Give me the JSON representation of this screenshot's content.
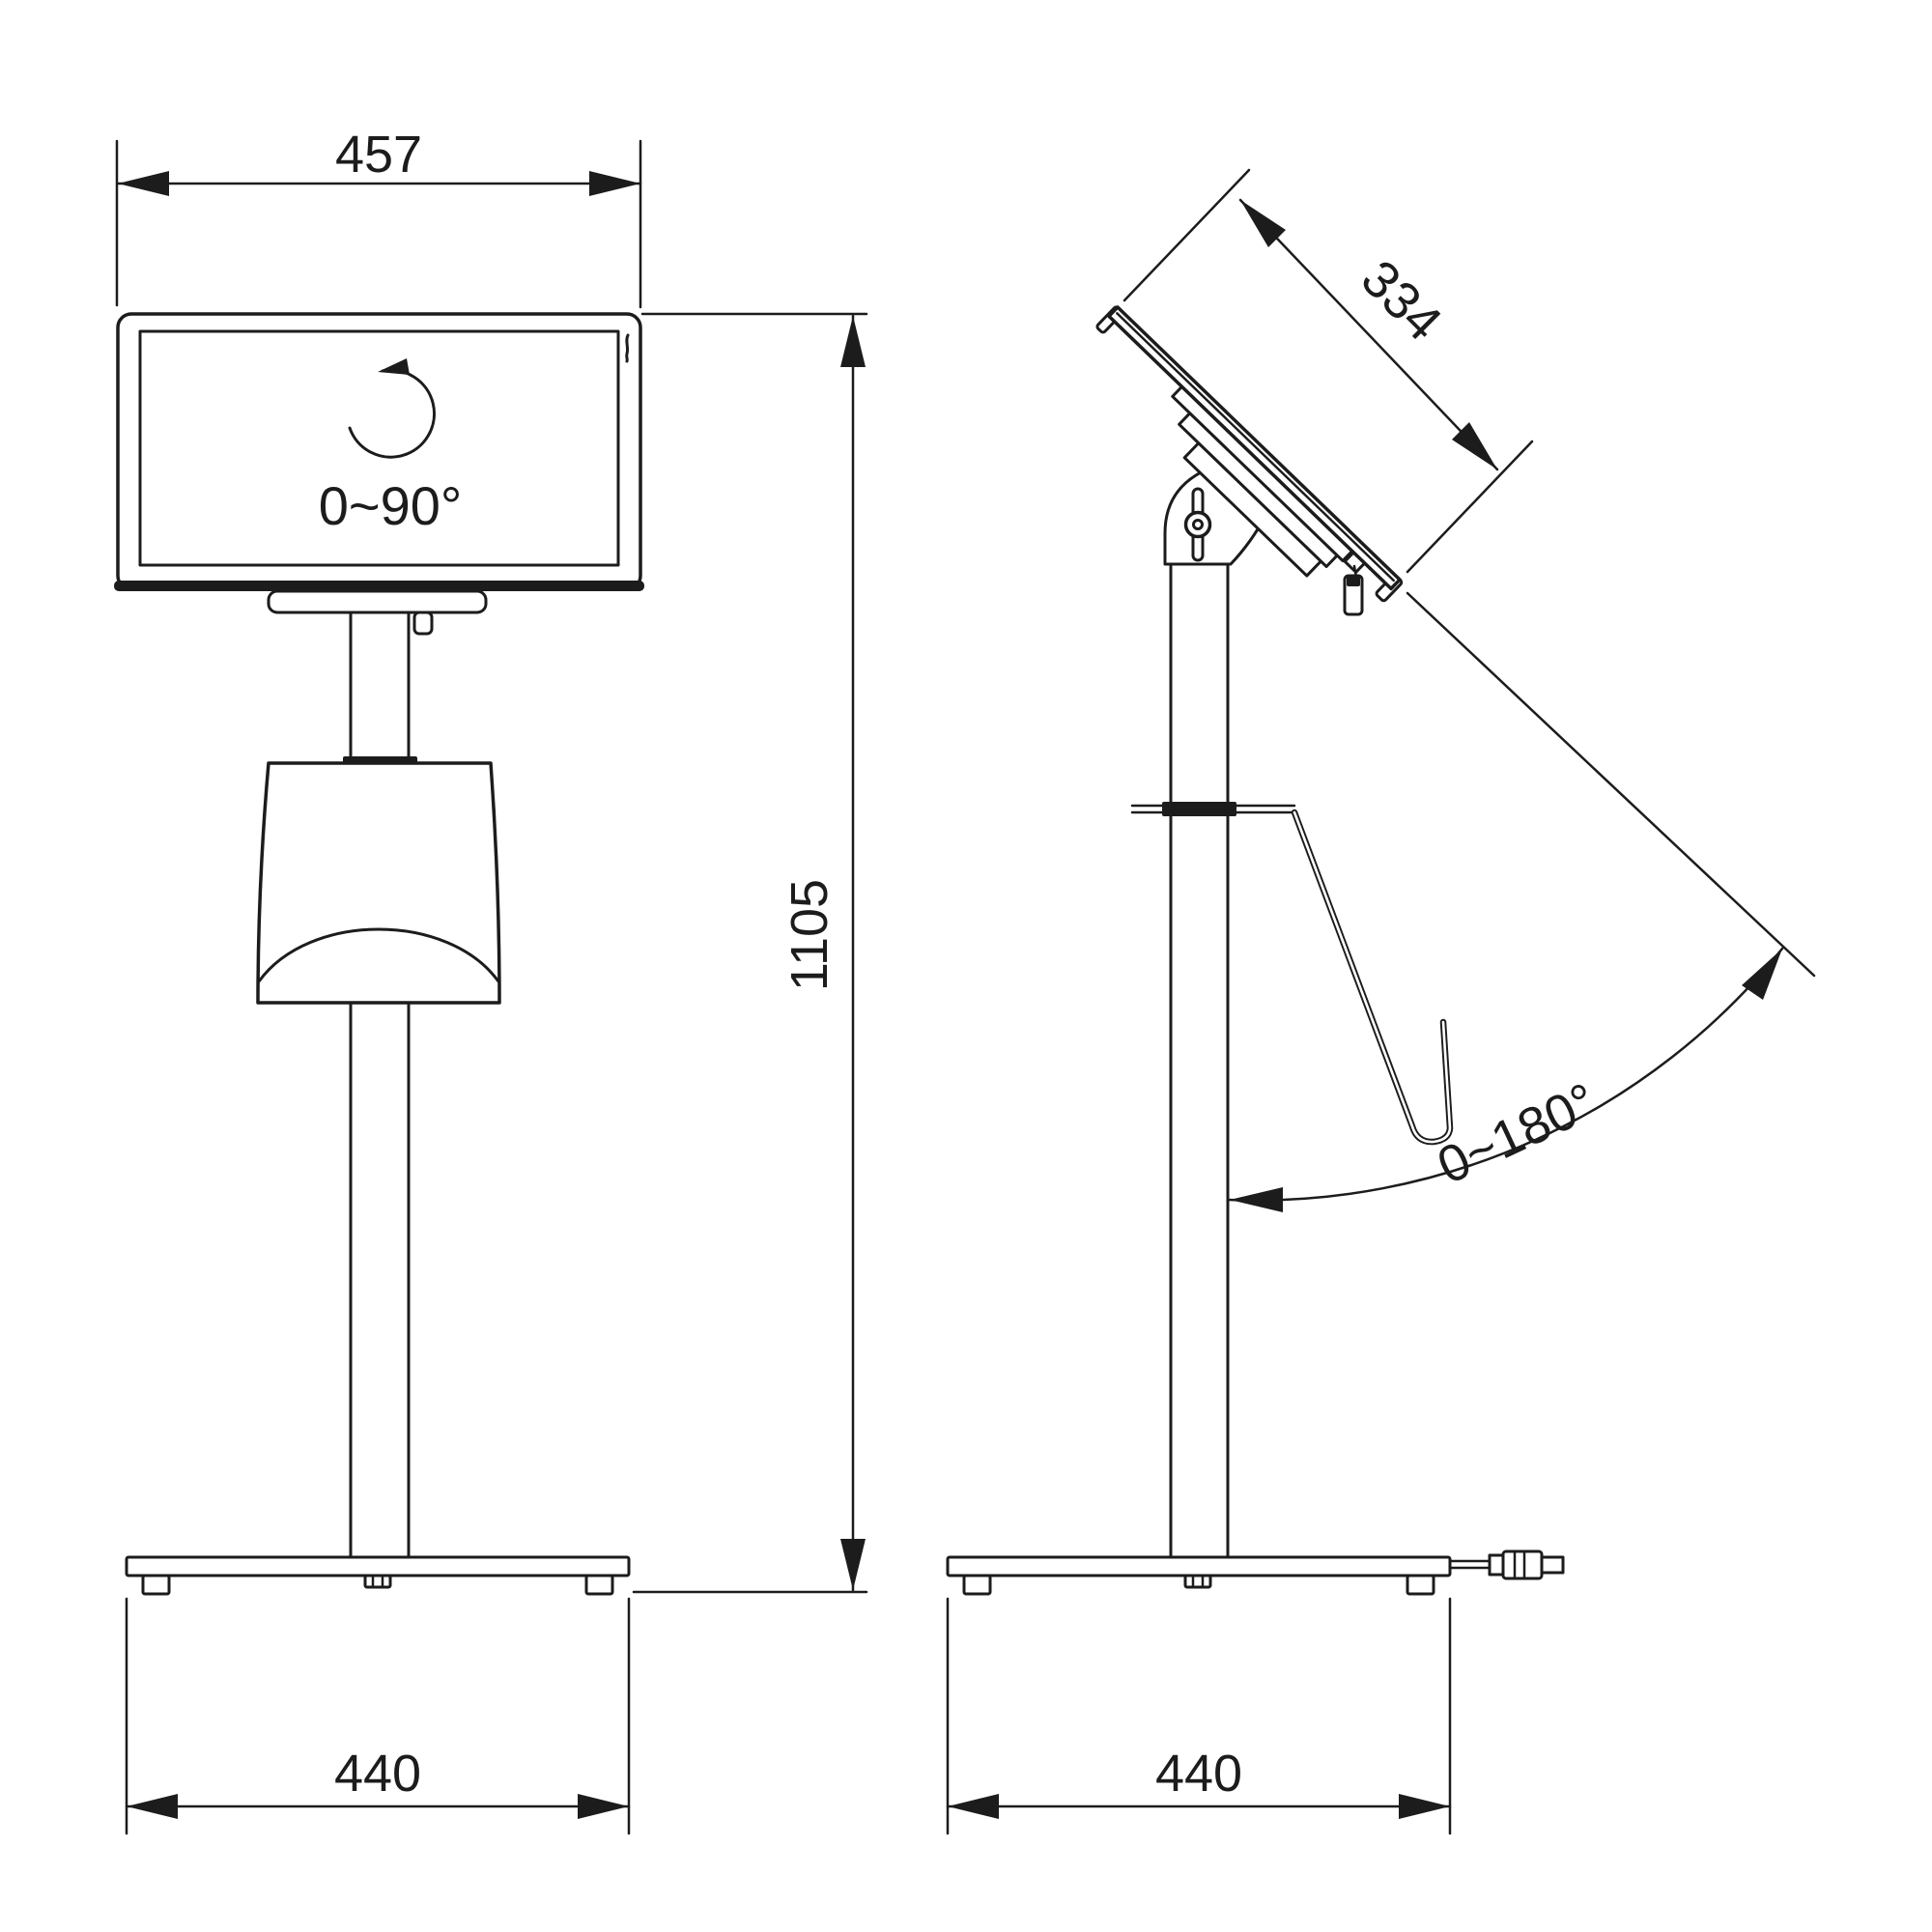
{
  "drawing": {
    "type": "technical-orthographic-drawing",
    "subject": "display floor stand, front and side views",
    "colors": {
      "background": "#ffffff",
      "line": "#1c1c1c"
    },
    "dimensions": {
      "screen_width": "457",
      "screen_depth": "334",
      "overall_height": "1105",
      "base_width_front": "440",
      "base_width_side": "440",
      "rotation_range": "0~90°",
      "tilt_range": "0~180°"
    }
  }
}
